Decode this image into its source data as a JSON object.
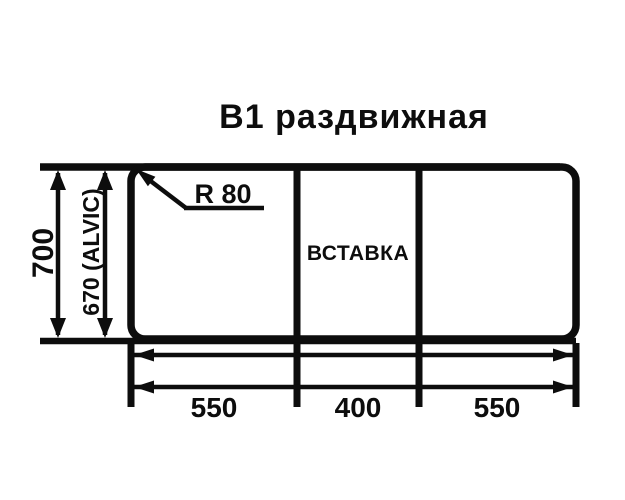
{
  "title": "B1 раздвижная",
  "colors": {
    "line": "#0d0d0d",
    "background": "#ffffff"
  },
  "diagram": {
    "radius_callout": "R 80",
    "insert_label": "ВСТАВКА",
    "height_outer": "700",
    "height_inner": "670 (ALVIC)",
    "widths": [
      "550",
      "400",
      "550"
    ]
  }
}
